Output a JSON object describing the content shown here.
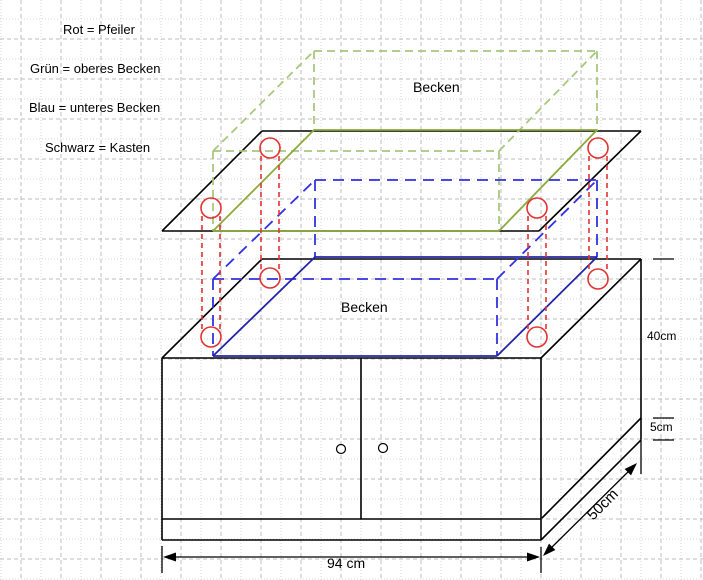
{
  "legend": {
    "items": [
      "Rot = Pfeiler",
      "Grün = oberes Becken",
      "Blau = unteres Becken",
      "Schwarz = Kasten"
    ]
  },
  "labels": {
    "upper_basin": "Becken",
    "lower_basin": "Becken"
  },
  "dimensions": {
    "width": "94 cm",
    "depth": "50cm",
    "body_height": "40cm",
    "plinth_height": "5cm"
  },
  "colors": {
    "pillar_red": "#e23333",
    "upper_basin_green_dashed": "#a8c87e",
    "upper_basin_green_solid": "#8ca93c",
    "lower_basin_blue_dashed": "#3232e0",
    "lower_basin_blue_solid": "#2424a8",
    "cabinet_black": "#000000",
    "grid_dashed": "#bcbcbc",
    "grid_dotted": "#d4d4d4",
    "background": "#ffffff"
  },
  "drawing": {
    "width": 703,
    "height": 580,
    "grid": {
      "spacing": 20,
      "x_start": 1,
      "y_start": 19
    },
    "styles": {
      "k": {
        "c": "#000000",
        "w": 1.6
      },
      "kd": {
        "c": "#000000",
        "w": 1.3
      },
      "gd": {
        "c": "#a8c87e",
        "w": 1.8,
        "d": "8 5"
      },
      "gs": {
        "c": "#8ca93c",
        "w": 1.8
      },
      "bd": {
        "c": "#3232e0",
        "w": 1.8,
        "d": "11 7"
      },
      "bs": {
        "c": "#2424a8",
        "w": 1.8
      },
      "rd": {
        "c": "#e23333",
        "w": 1.6,
        "d": "5 4"
      },
      "rc": {
        "c": "#e23333",
        "w": 1.6
      },
      "kn": {
        "c": "#000000",
        "w": 1.2,
        "f": "#ffffff"
      }
    },
    "segments": [
      [
        162,
        231,
        539,
        231,
        "k"
      ],
      [
        262,
        131,
        641,
        131,
        "k"
      ],
      [
        162,
        231,
        262,
        131,
        "k"
      ],
      [
        539,
        231,
        641,
        131,
        "k"
      ],
      [
        162,
        358,
        541,
        358,
        "k"
      ],
      [
        262,
        259,
        641,
        259,
        "k"
      ],
      [
        162,
        358,
        262,
        259,
        "k"
      ],
      [
        541,
        358,
        641,
        259,
        "k"
      ],
      [
        162,
        358,
        162,
        540,
        "k"
      ],
      [
        541,
        358,
        541,
        540,
        "k"
      ],
      [
        162,
        519,
        541,
        519,
        "k"
      ],
      [
        162,
        540,
        541,
        540,
        "k"
      ],
      [
        361,
        358,
        361,
        519,
        "k"
      ],
      [
        641,
        259,
        641,
        439,
        "k"
      ],
      [
        541,
        540,
        641,
        440,
        "k"
      ],
      [
        542,
        518,
        641,
        418,
        "k"
      ],
      [
        653,
        259,
        674,
        259,
        "kd"
      ],
      [
        653,
        418,
        674,
        418,
        "kd"
      ],
      [
        653,
        440,
        674,
        440,
        "kd"
      ],
      [
        641,
        439,
        641,
        474,
        "kd"
      ],
      [
        166,
        557,
        537,
        557,
        "kd"
      ],
      [
        162,
        546,
        162,
        573,
        "kd"
      ],
      [
        541,
        547,
        541,
        573,
        "kd"
      ],
      [
        546,
        553,
        634,
        466,
        "kd"
      ],
      [
        213,
        151,
        499,
        151,
        "gd"
      ],
      [
        314,
        51,
        597,
        51,
        "gd"
      ],
      [
        213,
        151,
        314,
        51,
        "gd"
      ],
      [
        499,
        151,
        597,
        51,
        "gd"
      ],
      [
        213,
        151,
        213,
        231,
        "gd"
      ],
      [
        499,
        151,
        499,
        231,
        "gd"
      ],
      [
        314,
        51,
        314,
        131,
        "gd"
      ],
      [
        597,
        51,
        597,
        131,
        "gd"
      ],
      [
        213,
        231,
        499,
        231,
        "gs"
      ],
      [
        314,
        130,
        597,
        130,
        "gs"
      ],
      [
        213,
        231,
        314,
        130,
        "gs"
      ],
      [
        499,
        231,
        597,
        130,
        "gs"
      ],
      [
        213,
        279,
        497,
        279,
        "bd"
      ],
      [
        315,
        180,
        597,
        180,
        "bd"
      ],
      [
        213,
        279,
        315,
        180,
        "bd"
      ],
      [
        497,
        279,
        597,
        180,
        "bd"
      ],
      [
        213,
        279,
        213,
        356,
        "bd"
      ],
      [
        497,
        279,
        497,
        355,
        "bd"
      ],
      [
        315,
        180,
        315,
        257,
        "bd"
      ],
      [
        597,
        180,
        597,
        257,
        "bd"
      ],
      [
        213,
        356,
        497,
        356,
        "bs"
      ],
      [
        315,
        257,
        597,
        257,
        "bs"
      ],
      [
        213,
        356,
        315,
        257,
        "bs"
      ],
      [
        497,
        356,
        597,
        257,
        "bs"
      ],
      [
        202,
        216,
        202,
        329,
        "rd"
      ],
      [
        220,
        216,
        220,
        329,
        "rd"
      ],
      [
        261,
        156,
        261,
        270,
        "rd"
      ],
      [
        279,
        156,
        279,
        270,
        "rd"
      ],
      [
        528,
        216,
        528,
        329,
        "rd"
      ],
      [
        546,
        216,
        546,
        329,
        "rd"
      ],
      [
        589,
        156,
        589,
        271,
        "rd"
      ],
      [
        607,
        156,
        607,
        271,
        "rd"
      ]
    ],
    "circles": [
      [
        211,
        208,
        10,
        "rc"
      ],
      [
        270,
        148,
        10,
        "rc"
      ],
      [
        537,
        208,
        10,
        "rc"
      ],
      [
        598,
        148,
        10,
        "rc"
      ],
      [
        211,
        337,
        10,
        "rc"
      ],
      [
        270,
        278,
        10,
        "rc"
      ],
      [
        537,
        337,
        10,
        "rc"
      ],
      [
        598,
        279,
        10,
        "rc"
      ],
      [
        341,
        449,
        4.5,
        "kn"
      ],
      [
        383,
        448,
        4.5,
        "kn"
      ]
    ],
    "arrows": [
      [
        163,
        557,
        180
      ],
      [
        540,
        557,
        0
      ],
      [
        543,
        556,
        135
      ],
      [
        637,
        463,
        -45
      ]
    ]
  }
}
